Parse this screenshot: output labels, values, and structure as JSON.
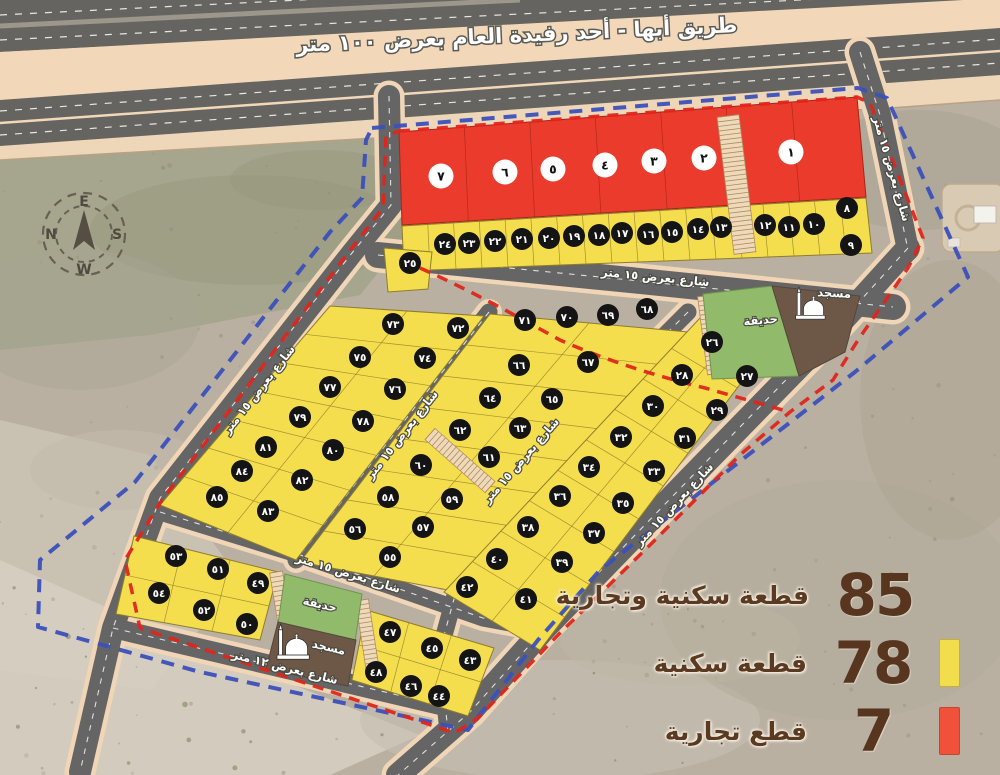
{
  "title_banner": {
    "text": "طريق أبها - أحد رفيدة العام بعرض ١٠٠ متر"
  },
  "compass": {
    "top": "E",
    "left": "N",
    "right": "S",
    "bottom": "W"
  },
  "legend": {
    "text_color": "#5b3a22",
    "items": [
      {
        "value": "85",
        "label": "قطعة سكنية وتجارية",
        "swatch": null
      },
      {
        "value": "78",
        "label": "قطعة سكنية",
        "swatch": "#f2de4d"
      },
      {
        "value": "7",
        "label": "قطع تجارية",
        "swatch": "#f1513b"
      }
    ]
  },
  "street_labels": [
    {
      "text": "شارع بعرض ١٥ متر",
      "x": 655,
      "y": 281,
      "rot": 5.5
    },
    {
      "text": "شارع بعرض ١٥ متر",
      "x": 888,
      "y": 170,
      "rot": 74
    },
    {
      "text": "شارع بعرض ١٥ متر",
      "x": 262,
      "y": 392,
      "rot": -52
    },
    {
      "text": "شارع بعرض ١٥ متر",
      "x": 405,
      "y": 437,
      "rot": -52
    },
    {
      "text": "شارع بعرض ١٥ متر",
      "x": 524,
      "y": 463,
      "rot": -49
    },
    {
      "text": "شارع بعرض ١٥ متر",
      "x": 677,
      "y": 507,
      "rot": -47
    },
    {
      "text": "شارع بعرض ١٥ متر",
      "x": 347,
      "y": 577,
      "rot": 17
    },
    {
      "text": "شارع بعرض ١٢ متر",
      "x": 284,
      "y": 671,
      "rot": 14
    }
  ],
  "landmarks": [
    {
      "type": "mosque",
      "label": "مسجد",
      "x": 834,
      "y": 297,
      "rot": 3
    },
    {
      "type": "park",
      "label": "حديقة",
      "x": 761,
      "y": 324,
      "rot": -5
    },
    {
      "type": "park",
      "label": "حديقة",
      "x": 319,
      "y": 608,
      "rot": 13
    },
    {
      "type": "mosque",
      "label": "مسجد",
      "x": 328,
      "y": 651,
      "rot": 13
    }
  ],
  "plots": {
    "commercial": {
      "color": "#ea3b2c",
      "items": [
        [
          "١",
          791,
          152
        ],
        [
          "٢",
          704,
          158
        ],
        [
          "٣",
          654,
          161
        ],
        [
          "٤",
          605,
          165
        ],
        [
          "٥",
          553,
          169
        ],
        [
          "٦",
          505,
          172
        ],
        [
          "٧",
          441,
          176
        ]
      ]
    },
    "residential": {
      "color": "#f4de4d",
      "items": [
        [
          "٨",
          847,
          208
        ],
        [
          "٩",
          851,
          245
        ],
        [
          "١٠",
          814,
          224
        ],
        [
          "١١",
          789,
          227
        ],
        [
          "١٢",
          765,
          225
        ],
        [
          "١٣",
          721,
          227
        ],
        [
          "١٤",
          698,
          229
        ],
        [
          "١٥",
          672,
          232
        ],
        [
          "١٦",
          648,
          234
        ],
        [
          "١٧",
          622,
          233
        ],
        [
          "١٨",
          599,
          235
        ],
        [
          "١٩",
          574,
          236
        ],
        [
          "٢٠",
          549,
          238
        ],
        [
          "٢١",
          522,
          239
        ],
        [
          "٢٢",
          495,
          241
        ],
        [
          "٢٣",
          469,
          243
        ],
        [
          "٢٤",
          445,
          244
        ],
        [
          "٢٥",
          410,
          263
        ],
        [
          "٢٦",
          712,
          342
        ],
        [
          "٢٧",
          747,
          376
        ],
        [
          "٢٨",
          682,
          375
        ],
        [
          "٢٩",
          717,
          410
        ],
        [
          "٣٠",
          653,
          406
        ],
        [
          "٣١",
          685,
          438
        ],
        [
          "٣٢",
          621,
          437
        ],
        [
          "٣٣",
          654,
          471
        ],
        [
          "٣٤",
          589,
          467
        ],
        [
          "٣٥",
          623,
          503
        ],
        [
          "٣٦",
          560,
          496
        ],
        [
          "٣٧",
          594,
          533
        ],
        [
          "٣٨",
          528,
          527
        ],
        [
          "٣٩",
          562,
          562
        ],
        [
          "٤٠",
          497,
          559
        ],
        [
          "٤١",
          526,
          599
        ],
        [
          "٤٢",
          467,
          587
        ],
        [
          "٤٣",
          470,
          660
        ],
        [
          "٤٤",
          439,
          696
        ],
        [
          "٤٥",
          432,
          648
        ],
        [
          "٤٦",
          411,
          686
        ],
        [
          "٤٧",
          390,
          632
        ],
        [
          "٤٨",
          376,
          672
        ],
        [
          "٤٩",
          258,
          583
        ],
        [
          "٥٠",
          247,
          624
        ],
        [
          "٥١",
          218,
          569
        ],
        [
          "٥٢",
          204,
          610
        ],
        [
          "٥٣",
          176,
          556
        ],
        [
          "٥٤",
          159,
          593
        ],
        [
          "٥٥",
          390,
          557
        ],
        [
          "٥٦",
          355,
          529
        ],
        [
          "٥٧",
          423,
          527
        ],
        [
          "٥٨",
          388,
          497
        ],
        [
          "٥٩",
          452,
          499
        ],
        [
          "٦٠",
          421,
          465
        ],
        [
          "٦١",
          489,
          457
        ],
        [
          "٦٢",
          460,
          430
        ],
        [
          "٦٣",
          520,
          428
        ],
        [
          "٦٤",
          490,
          398
        ],
        [
          "٦٥",
          552,
          399
        ],
        [
          "٦٦",
          519,
          365
        ],
        [
          "٦٧",
          588,
          362
        ],
        [
          "٦٨",
          647,
          309
        ],
        [
          "٦٩",
          608,
          315
        ],
        [
          "٧٠",
          567,
          317
        ],
        [
          "٧١",
          525,
          320
        ],
        [
          "٧٢",
          458,
          328
        ],
        [
          "٧٣",
          393,
          324
        ],
        [
          "٧٤",
          425,
          358
        ],
        [
          "٧٥",
          360,
          357
        ],
        [
          "٧٦",
          395,
          389
        ],
        [
          "٧٧",
          330,
          387
        ],
        [
          "٧٨",
          363,
          421
        ],
        [
          "٧٩",
          300,
          417
        ],
        [
          "٨٠",
          333,
          450
        ],
        [
          "٨١",
          266,
          447
        ],
        [
          "٨٢",
          302,
          480
        ],
        [
          "٨٣",
          268,
          511
        ],
        [
          "٨٤",
          242,
          471
        ],
        [
          "٨٥",
          217,
          497
        ]
      ]
    }
  },
  "colors": {
    "commercial": "#ea3b2c",
    "residential": "#f4de4d",
    "road": "#656565",
    "road_casing": "#f0d6b6",
    "boundary_blue": "#3b50bb",
    "boundary_red": "#e0251b",
    "park": "#92ba6b",
    "mosque_area": "#6d5847"
  }
}
